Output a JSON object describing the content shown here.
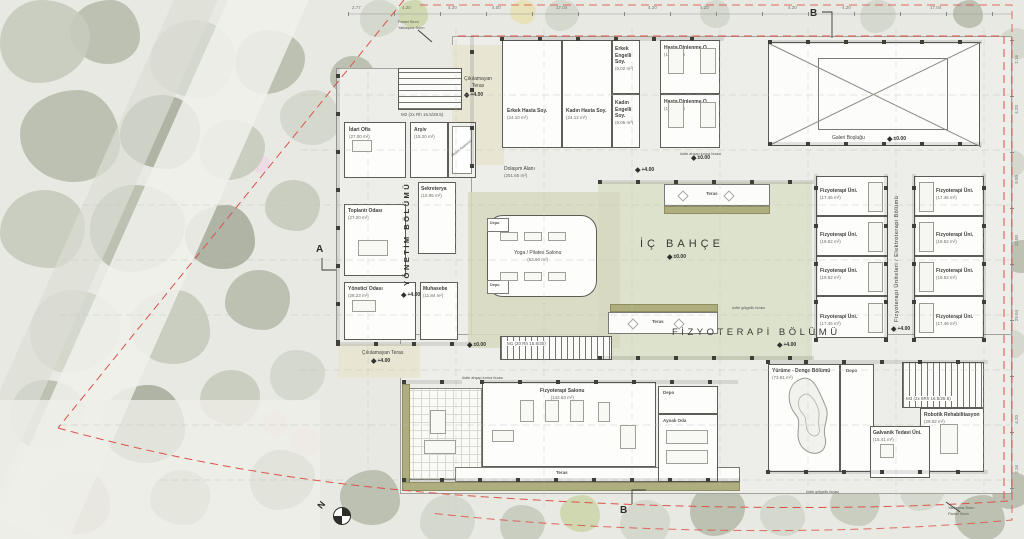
{
  "levels": {
    "zero": "±0.00",
    "four": "+4.00"
  },
  "labels": {
    "teras": "Teras",
    "depo": "Depo",
    "north": "N",
    "section_a": "A",
    "section_b": "B"
  },
  "boundary": {
    "parsel": "Parsel Sınırı",
    "yaklasma": "Yaklaşma Sınırı"
  },
  "annotations": {
    "golgelik": "üstte gölgelik hizası",
    "ahsap": "üstte ahşap kırma hizası"
  },
  "sections": {
    "yonetim": {
      "label": "YÖNETİM BÖLÜMÜ"
    },
    "fizyoterapi": {
      "label": "FİZYOTERAPİ BÖLÜMÜ"
    },
    "elektroterapi": {
      "label": "Fizyoterapi Üniteleri / Elektroterapi Bölümü"
    },
    "ic_bahce": {
      "label": "İÇ BAHÇE"
    }
  },
  "rooms": {
    "idari_ofis": {
      "name": "İdari Ofis",
      "area": "(27.00 m²)"
    },
    "arsiv": {
      "name": "Arşiv",
      "area": "(15.20 m²)"
    },
    "sedye_asansoru": {
      "name": "Sedye Asansörü"
    },
    "toplanti_odasi": {
      "name": "Toplantı Odası",
      "area": "(27.20 m²)"
    },
    "sekreterya": {
      "name": "Sekreterya",
      "area": "(15.95 m²)"
    },
    "yonetici_odasi": {
      "name": "Yönetici Odası",
      "area": "(28.23 m²)"
    },
    "muhasebe": {
      "name": "Muhasebe",
      "area": "(11.84 m²)"
    },
    "erkek_hasta": {
      "name": "Erkek Hasta Soy.",
      "area": "(24.10 m²)"
    },
    "kadin_hasta": {
      "name": "Kadın Hasta Soy.",
      "area": "(24.12 m²)"
    },
    "erkek_engelli": {
      "name": "Erkek Engelli Soy.",
      "area": "(6.02 m²)"
    },
    "kadin_engelli": {
      "name": "Kadın Engelli Soy.",
      "area": "(6.05 m²)"
    },
    "hasta_dinlenme": {
      "name": "Hasta Dinlenme O.",
      "area": "(19.46 m²)"
    },
    "galeri": {
      "name": "Galeri Boşluğu"
    },
    "dolasim": {
      "name": "Dolaşım Alanı",
      "area": "(251.65 m²)"
    },
    "yoga": {
      "name": "Yoga / Pilates Salonu",
      "area": "(62.60 m²)"
    },
    "fizyo_salon": {
      "name": "Fizyoterapi Salonu",
      "area": "(142.63 m²)"
    },
    "aynali": {
      "name": "Aynalı Oda"
    },
    "yurume": {
      "name": "Yürüme - Denge Bölümü",
      "area": "(73.81 m²)"
    },
    "robotik": {
      "name": "Robotik Rehabilitasyon",
      "area": "(29.02 m²)"
    },
    "galvanik": {
      "name": "Galvanik Tedavi Üni.",
      "area": "(15.41 m²)"
    },
    "cikilamayan": {
      "name": "Çıkılamayan Teras"
    }
  },
  "stairs": {
    "m1": {
      "name": "M1",
      "info": "(20 Rh 15.8/30)"
    },
    "m2": {
      "name": "M2",
      "info": "(2x Rh 16.5/28.5)"
    },
    "m3": {
      "name": "M3",
      "info": "(2x 8Rh 16.5/28.5)"
    }
  },
  "units": {
    "left": [
      {
        "name": "Fizyoterapi Üni.",
        "area": "(17.46 m²)"
      },
      {
        "name": "Fizyoterapi Üni.",
        "area": "(19.52 m²)"
      },
      {
        "name": "Fizyoterapi Üni.",
        "area": "(19.52 m²)"
      },
      {
        "name": "Fizyoterapi Üni.",
        "area": "(17.46 m²)"
      }
    ],
    "right": [
      {
        "name": "Fizyoterapi Üni.",
        "area": "(17.46 m²)"
      },
      {
        "name": "Fizyoterapi Üni.",
        "area": "(19.52 m²)"
      },
      {
        "name": "Fizyoterapi Üni.",
        "area": "(19.52 m²)"
      },
      {
        "name": "Fizyoterapi Üni.",
        "area": "(17.46 m²)"
      }
    ]
  },
  "dimensions": {
    "top": [
      "2.77",
      "4.20",
      "4.20",
      "4.00",
      "17.04",
      "4.20",
      "4.20",
      "4.20",
      "4.20",
      "17.04"
    ],
    "right": [
      "2.16",
      "4.20",
      "8.00",
      "12.00",
      "29.04",
      "4.20",
      "2.16"
    ]
  },
  "colors": {
    "boundary_red": "#d9534a",
    "planter_olive": "#aeae7e",
    "courtyard_green": "#dde2cd"
  }
}
